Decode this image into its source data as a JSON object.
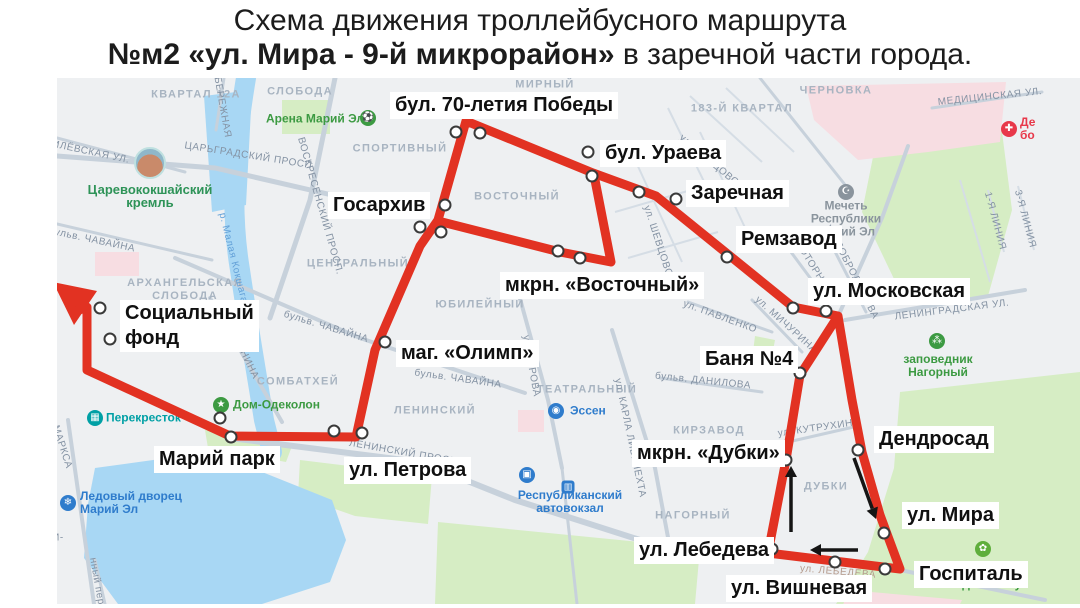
{
  "title": {
    "line1": "Схема движения троллейбусного маршрута",
    "line2_bold": "№м2 «ул. Мира - 9-й микрорайон»",
    "line2_rest": " в заречной части города."
  },
  "colors": {
    "route_red": "#e23222",
    "water": "#a8d7f4",
    "green_area": "#d6edc4",
    "pink_area": "#f7dde2",
    "road": "#c7d1db",
    "road_thin": "#d5dde5",
    "district_text": "#a8b4c1",
    "street_text": "#8492a3",
    "poi_green": "#3c9a42",
    "poi_blue": "#2f7ccc",
    "poi_teal": "#00a0a5",
    "poi_grey": "#8a949d",
    "poi_red": "#e8384a",
    "river_text": "#64a1d8",
    "lebedeva_text": "#b59b8d",
    "arrow_black": "#151515"
  },
  "map": {
    "stops": [
      {
        "label": "бул. 70-летия Победы",
        "x": 390,
        "y": 92
      },
      {
        "label": "бул. Ураева",
        "x": 600,
        "y": 140
      },
      {
        "label": "Заречная",
        "x": 686,
        "y": 180
      },
      {
        "label": "Ремзавод",
        "x": 736,
        "y": 226
      },
      {
        "label": "ул. Московская",
        "x": 808,
        "y": 278
      },
      {
        "label": "Госархив",
        "x": 328,
        "y": 192
      },
      {
        "label": "мкрн. «Восточный»",
        "x": 500,
        "y": 272
      },
      {
        "label": "Социальный\nфонд",
        "x": 120,
        "y": 300
      },
      {
        "label": "маг. «Олимп»",
        "x": 396,
        "y": 340
      },
      {
        "label": "Баня №4",
        "x": 700,
        "y": 346
      },
      {
        "label": "Дендросад",
        "x": 874,
        "y": 426
      },
      {
        "label": "Марий парк",
        "x": 154,
        "y": 446
      },
      {
        "label": "ул. Петрова",
        "x": 344,
        "y": 457
      },
      {
        "label": "мкрн. «Дубки»",
        "x": 632,
        "y": 440
      },
      {
        "label": "ул. Мира",
        "x": 902,
        "y": 502
      },
      {
        "label": "ул. Лебедева",
        "x": 634,
        "y": 537
      },
      {
        "label": "ул. Вишневая",
        "x": 726,
        "y": 575
      },
      {
        "label": "Госпиталь",
        "x": 914,
        "y": 561
      }
    ],
    "stop_points": [
      [
        456,
        132
      ],
      [
        480,
        133
      ],
      [
        588,
        152
      ],
      [
        592,
        176
      ],
      [
        639,
        192
      ],
      [
        676,
        199
      ],
      [
        727,
        257
      ],
      [
        793,
        308
      ],
      [
        826,
        311
      ],
      [
        445,
        205
      ],
      [
        420,
        227
      ],
      [
        441,
        232
      ],
      [
        558,
        251
      ],
      [
        580,
        258
      ],
      [
        385,
        342
      ],
      [
        362,
        433
      ],
      [
        334,
        431
      ],
      [
        220,
        418
      ],
      [
        231,
        437
      ],
      [
        100,
        308
      ],
      [
        110,
        339
      ],
      [
        800,
        373
      ],
      [
        786,
        460
      ],
      [
        772,
        549
      ],
      [
        835,
        562
      ],
      [
        885,
        569
      ],
      [
        858,
        450
      ],
      [
        884,
        533
      ]
    ],
    "route_path": [
      [
        87,
        307
      ],
      [
        87,
        370
      ],
      [
        230,
        436
      ],
      [
        356,
        437
      ],
      [
        375,
        350
      ],
      [
        420,
        246
      ],
      [
        438,
        220
      ],
      [
        466,
        121
      ],
      [
        593,
        173
      ],
      [
        656,
        196
      ],
      [
        793,
        307
      ],
      [
        838,
        316
      ],
      [
        852,
        400
      ],
      [
        862,
        452
      ],
      [
        880,
        515
      ],
      [
        900,
        569
      ],
      [
        768,
        553
      ],
      [
        786,
        460
      ],
      [
        800,
        375
      ],
      [
        838,
        316
      ]
    ],
    "route_inner": [
      [
        438,
        221
      ],
      [
        560,
        252
      ],
      [
        611,
        262
      ],
      [
        594,
        175
      ]
    ],
    "terminus_arrowhead": [
      [
        53,
        282
      ],
      [
        97,
        291
      ],
      [
        74,
        325
      ]
    ],
    "direction_arrows": [
      {
        "from": [
          791,
          532
        ],
        "to": [
          791,
          466
        ]
      },
      {
        "from": [
          854,
          458
        ],
        "to": [
          876,
          519
        ]
      },
      {
        "from": [
          858,
          550
        ],
        "to": [
          810,
          550
        ]
      }
    ],
    "districts": [
      {
        "text": "КВАРТАЛ 12А",
        "x": 196,
        "y": 95
      },
      {
        "text": "СЛОБОДА",
        "x": 300,
        "y": 92
      },
      {
        "text": "МИРНЫЙ",
        "x": 545,
        "y": 85
      },
      {
        "text": "СПОРТИВНЫЙ",
        "x": 400,
        "y": 149
      },
      {
        "text": "ВОСТОЧНЫЙ",
        "x": 517,
        "y": 197
      },
      {
        "text": "ЦЕНТРАЛЬНЫЙ",
        "x": 358,
        "y": 264
      },
      {
        "text": "АРХАНГЕЛЬСКАЯ\nСЛОБОДА",
        "x": 185,
        "y": 290
      },
      {
        "text": "ЮБИЛЕЙНЫЙ",
        "x": 480,
        "y": 305
      },
      {
        "text": "СОМБАТХЕЙ",
        "x": 298,
        "y": 382
      },
      {
        "text": "ЛЕНИНСКИЙ",
        "x": 435,
        "y": 411
      },
      {
        "text": "ТЕАТРАЛЬНЫЙ",
        "x": 587,
        "y": 390
      },
      {
        "text": "КИРЗАВОД",
        "x": 709,
        "y": 431
      },
      {
        "text": "НАГОРНЫЙ",
        "x": 693,
        "y": 516
      },
      {
        "text": "ДУБКИ",
        "x": 826,
        "y": 487
      },
      {
        "text": "ЧЕРНОВКА",
        "x": 836,
        "y": 91
      },
      {
        "text": "183-Й КВАРТАЛ",
        "x": 742,
        "y": 109
      }
    ],
    "streets": [
      {
        "text": "ЦАРЬГРАДСКИЙ ПРОСП.",
        "x": 250,
        "y": 156,
        "rot": 9
      },
      {
        "text": "ВОСКРЕСЕНСКИЙ ПРОСП.",
        "x": 320,
        "y": 206,
        "rot": 74
      },
      {
        "text": "НАБЕРЕЖНАЯ",
        "x": 221,
        "y": 100,
        "rot": 80
      },
      {
        "text": "КРЕМЛЁВСКАЯ УЛ.",
        "x": 80,
        "y": 150,
        "rot": 12
      },
      {
        "text": "бульв. ЧАВАЙНА",
        "x": 92,
        "y": 240,
        "rot": 12
      },
      {
        "text": "бульв. ЧАВАЙНА",
        "x": 326,
        "y": 327,
        "rot": 17
      },
      {
        "text": "бульв. ЧАВАЙНА",
        "x": 458,
        "y": 379,
        "rot": 8
      },
      {
        "text": "ул. ЭШКИНИНА",
        "x": 238,
        "y": 342,
        "rot": 64
      },
      {
        "text": "ЛЕНИНСКИЙ ПРОСП.",
        "x": 405,
        "y": 453,
        "rot": 10
      },
      {
        "text": "ул. КАРЛА ЛИБКНЕХТА",
        "x": 630,
        "y": 438,
        "rot": 78
      },
      {
        "text": "ул. КИРОВА",
        "x": 531,
        "y": 366,
        "rot": 80
      },
      {
        "text": "ул. ШЕВЦОВОЙ",
        "x": 659,
        "y": 245,
        "rot": 72
      },
      {
        "text": "ул. ШЕВЦОВОЙ",
        "x": 712,
        "y": 163,
        "rot": 40
      },
      {
        "text": "ул. ПАВЛЕНКО",
        "x": 720,
        "y": 317,
        "rot": 20
      },
      {
        "text": "ул. МИЧУРИНА",
        "x": 786,
        "y": 325,
        "rot": 42
      },
      {
        "text": "МОТОРНАЯ",
        "x": 813,
        "y": 267,
        "rot": 58
      },
      {
        "text": "ул. ДОБРОЛЮБОВА",
        "x": 852,
        "y": 272,
        "rot": 63
      },
      {
        "text": "ЛЕНИНГРАДСКАЯ УЛ.",
        "x": 952,
        "y": 310,
        "rot": -7
      },
      {
        "text": "МЕДИЦИНСКАЯ УЛ.",
        "x": 990,
        "y": 97,
        "rot": -6
      },
      {
        "text": "1-Я ЛИНИЯ",
        "x": 995,
        "y": 221,
        "rot": 75
      },
      {
        "text": "3-Я ЛИНИЯ",
        "x": 1025,
        "y": 219,
        "rot": 75
      },
      {
        "text": "ул. КУТРУХИНА",
        "x": 819,
        "y": 428,
        "rot": -8
      },
      {
        "text": "ул. ЛЕБЕДЕВА",
        "x": 838,
        "y": 572,
        "rot": 5,
        "color": "#b59b8d"
      },
      {
        "text": "МАРКСА",
        "x": 62,
        "y": 447,
        "rot": 72
      },
      {
        "text": "нный пер.",
        "x": 97,
        "y": 583,
        "rot": 80
      },
      {
        "text": "бульв. ДАНИЛОВА",
        "x": 703,
        "y": 381,
        "rot": 6
      },
      {
        "text": "И-",
        "x": 58,
        "y": 538,
        "rot": 0
      },
      {
        "text": "р. Малая Кокшага",
        "x": 233,
        "y": 258,
        "rot": 76,
        "color": "#64a1d8"
      }
    ],
    "pois": [
      {
        "id": "arena",
        "name": "stadium-icon",
        "glyph": "⚽",
        "bg": "#3c9a42",
        "ix": 368,
        "iy": 118,
        "text": "Арена Марий Эл",
        "tx": 315,
        "ty": 119,
        "align": "center",
        "color": "#3c9a42"
      },
      {
        "id": "kremlin",
        "name": "kremlin-photo-icon",
        "glyph": "",
        "bg": "kremlin",
        "ix": 150,
        "iy": 163,
        "text": "Царевококшайский\nкремль",
        "tx": 150,
        "ty": 196,
        "align": "center",
        "color": "#2e9358",
        "size": 13
      },
      {
        "id": "perekrestok",
        "name": "supermarket-icon",
        "glyph": "▦",
        "bg": "#00a0a5",
        "ix": 95,
        "iy": 418,
        "text": "Перекресток",
        "tx": 106,
        "ty": 418,
        "align": "left",
        "color": "#00a0a5"
      },
      {
        "id": "dom-odekolon",
        "name": "star-icon",
        "glyph": "★",
        "bg": "#3c9a42",
        "ix": 221,
        "iy": 405,
        "text": "Дом-Одеколон",
        "tx": 233,
        "ty": 405,
        "align": "left",
        "color": "#3c9a42"
      },
      {
        "id": "essen",
        "name": "store-icon",
        "glyph": "◉",
        "bg": "#2f7ccc",
        "ix": 556,
        "iy": 411,
        "text": "Эссен",
        "tx": 570,
        "ty": 411,
        "align": "left",
        "color": "#2f7ccc"
      },
      {
        "id": "ice-palace",
        "name": "ice-palace-icon",
        "glyph": "❄",
        "bg": "#2f7ccc",
        "ix": 68,
        "iy": 503,
        "text": "Ледовый дворец\nМарий Эл",
        "tx": 80,
        "ty": 503,
        "align": "left",
        "color": "#2f7ccc"
      },
      {
        "id": "avtovokzal",
        "name": "bus-station-icon",
        "glyph": "▣",
        "bg": "#2f7ccc",
        "ix": 527,
        "iy": 475,
        "text": "Республиканский\nавтовокзал",
        "tx": 570,
        "ty": 502,
        "align": "center",
        "color": "#2f7ccc",
        "sq": [
          568,
          487
        ]
      },
      {
        "id": "mosque",
        "name": "mosque-icon",
        "glyph": "☪",
        "bg": "#8a949d",
        "ix": 846,
        "iy": 192,
        "text": "Мечеть\nРеспублики\nМарий Эл",
        "tx": 846,
        "ty": 219,
        "align": "center",
        "color": "#8a949d"
      },
      {
        "id": "zapovednik",
        "name": "paw-icon",
        "glyph": "⁂",
        "bg": "#3c9a42",
        "ix": 937,
        "iy": 341,
        "text": "заповедник\nНагорный",
        "tx": 938,
        "ty": 366,
        "align": "center",
        "color": "#3c9a42"
      },
      {
        "id": "pgtu-garden",
        "name": "leaf-icon",
        "glyph": "✿",
        "bg": "#5fae3c",
        "ix": 983,
        "iy": 549,
        "text": "ПГТУ\nсад-институт",
        "tx": 988,
        "ty": 578,
        "align": "center",
        "color": "#3c9a42"
      },
      {
        "id": "hospital-poi",
        "name": "medical-cross-icon",
        "glyph": "✚",
        "bg": "#e8384a",
        "ix": 1009,
        "iy": 129,
        "text": "Де\nбо",
        "tx": 1020,
        "ty": 129,
        "align": "left",
        "color": "#e8384a"
      }
    ]
  }
}
